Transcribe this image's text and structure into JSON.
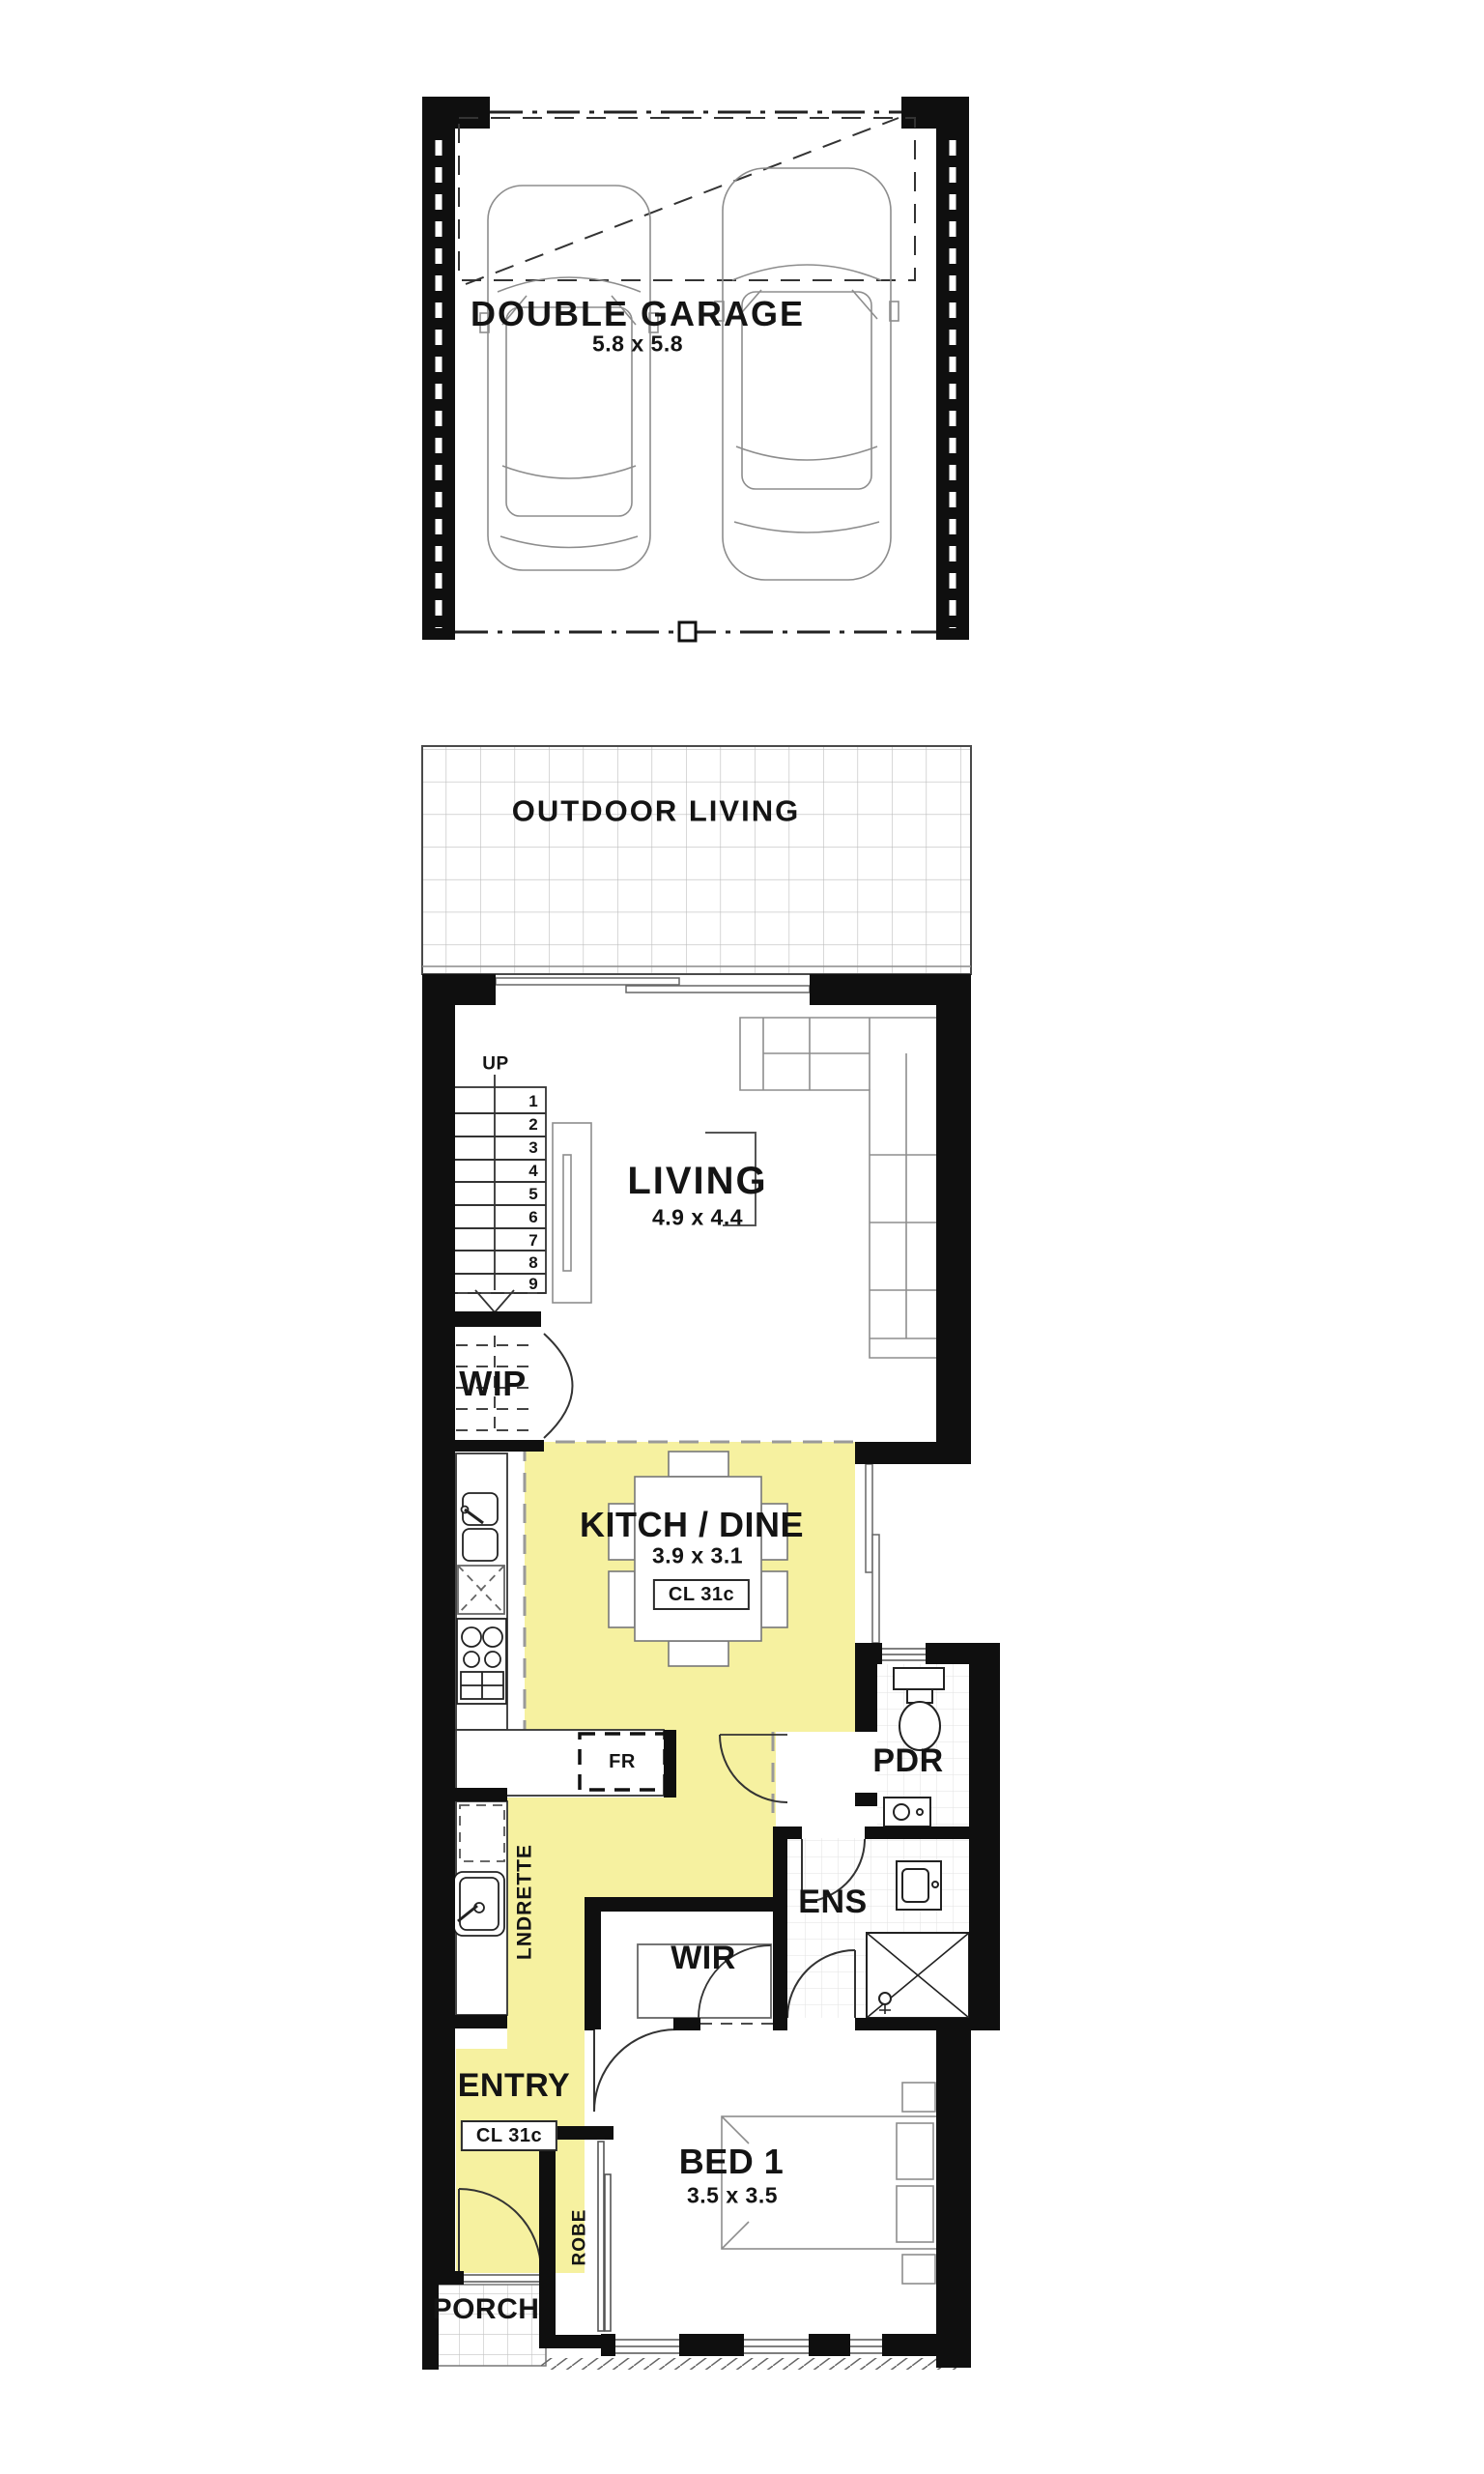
{
  "plan": {
    "garage": {
      "label": "DOUBLE GARAGE",
      "dim": "5.8 x 5.8"
    },
    "outdoor_living": {
      "label": "OUTDOOR LIVING"
    },
    "living": {
      "label": "LIVING",
      "dim": "4.9 x 4.4"
    },
    "stairs": {
      "up_label": "UP",
      "numbers": [
        "1",
        "2",
        "3",
        "4",
        "5",
        "6",
        "7",
        "8",
        "9"
      ]
    },
    "wip": {
      "label": "WIP"
    },
    "kitchen_dine": {
      "label": "KITCH / DINE",
      "dim": "3.9 x 3.1",
      "ceiling_tag": "CL 31c"
    },
    "fridge": {
      "label": "FR"
    },
    "pdr": {
      "label": "PDR"
    },
    "laundry": {
      "label": "LNDRETTE"
    },
    "ens": {
      "label": "ENS"
    },
    "wir": {
      "label": "WIR"
    },
    "entry": {
      "label": "ENTRY",
      "ceiling_tag": "CL 31c"
    },
    "bed1": {
      "label": "BED 1",
      "dim": "3.5 x 3.5"
    },
    "robe": {
      "label": "ROBE"
    },
    "porch": {
      "label": "PORCH"
    }
  },
  "colors": {
    "highlight": "#F6F1A0",
    "wall": "#0f0f0f",
    "line": "#555555",
    "tile": "#c9c9c9"
  }
}
